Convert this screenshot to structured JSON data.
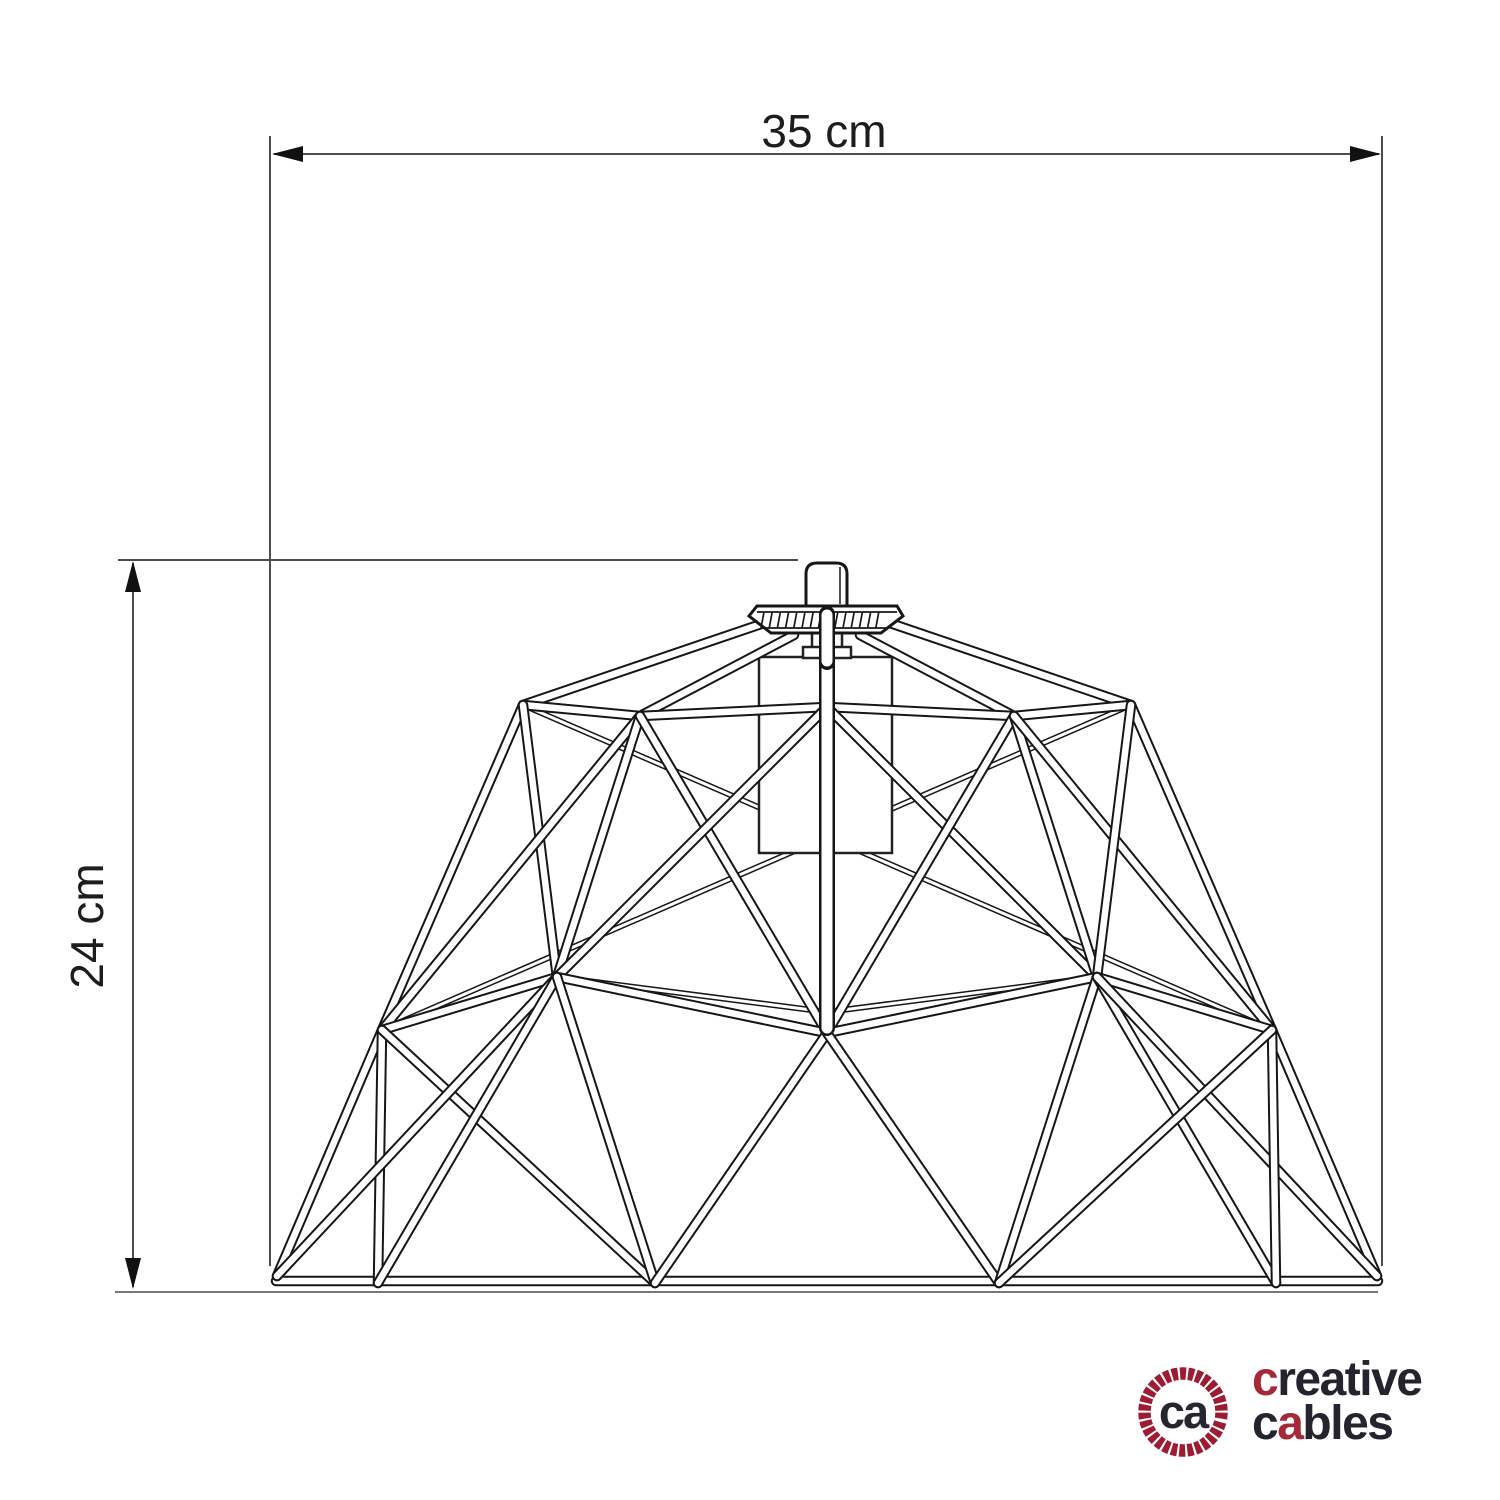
{
  "page": {
    "background": "#ffffff"
  },
  "dimensions": {
    "width_label": "35 cm",
    "height_label": "24 cm",
    "line_color": "#4d4d4d",
    "arrow_color": "#111111"
  },
  "logo": {
    "monogram": "ca",
    "word1": {
      "accent": "c",
      "rest": "reative"
    },
    "word2": {
      "pre": "c",
      "accent": "a",
      "rest": "bles"
    },
    "accent_color": "#a52a39",
    "text_color": "#24242e",
    "ring_color": "#9e1c33"
  },
  "drawing": {
    "stroke": "#161616",
    "fill": "#ffffff",
    "widths": {
      "m": [
        10.5,
        6.5
      ],
      "r": [
        16,
        11
      ],
      "t": [
        6,
        3
      ]
    },
    "back_struts": [
      [
        523,
        705,
        1272,
        1030,
        "t"
      ],
      [
        1131,
        705,
        382,
        1030,
        "t"
      ],
      [
        557,
        977,
        827,
        1012,
        "t"
      ],
      [
        827,
        1012,
        1097,
        977,
        "t"
      ]
    ],
    "struts": [
      [
        276,
        1281,
        1378,
        1281,
        "m"
      ],
      [
        277,
        1276,
        382,
        1030,
        "m"
      ],
      [
        382,
        1030,
        523,
        705,
        "m"
      ],
      [
        1377,
        1276,
        1272,
        1030,
        "m"
      ],
      [
        1272,
        1030,
        1131,
        705,
        "m"
      ],
      [
        523,
        705,
        770,
        621,
        "m"
      ],
      [
        1131,
        705,
        884,
        621,
        "m"
      ],
      [
        794,
        635,
        640,
        716,
        "m"
      ],
      [
        860,
        635,
        1014,
        716,
        "m"
      ],
      [
        523,
        705,
        640,
        716,
        "m"
      ],
      [
        640,
        716,
        827,
        707,
        "m"
      ],
      [
        827,
        707,
        1014,
        716,
        "m"
      ],
      [
        1014,
        716,
        1131,
        705,
        "m"
      ],
      [
        523,
        705,
        557,
        977,
        "m"
      ],
      [
        640,
        716,
        382,
        1030,
        "m"
      ],
      [
        640,
        716,
        557,
        977,
        "m"
      ],
      [
        640,
        716,
        827,
        1033,
        "m"
      ],
      [
        827,
        707,
        557,
        977,
        "m"
      ],
      [
        827,
        707,
        1097,
        977,
        "m"
      ],
      [
        1014,
        716,
        827,
        1033,
        "m"
      ],
      [
        1014,
        716,
        1097,
        977,
        "m"
      ],
      [
        1014,
        716,
        1272,
        1030,
        "m"
      ],
      [
        1131,
        705,
        1097,
        977,
        "m"
      ],
      [
        382,
        1030,
        557,
        977,
        "m"
      ],
      [
        557,
        977,
        827,
        1033,
        "m"
      ],
      [
        827,
        1033,
        1097,
        977,
        "m"
      ],
      [
        1097,
        977,
        1272,
        1030,
        "m"
      ],
      [
        382,
        1030,
        378,
        1283,
        "m"
      ],
      [
        382,
        1030,
        655,
        1283,
        "m"
      ],
      [
        277,
        1276,
        557,
        977,
        "m"
      ],
      [
        557,
        977,
        378,
        1283,
        "m"
      ],
      [
        557,
        977,
        655,
        1283,
        "m"
      ],
      [
        827,
        1033,
        655,
        1283,
        "m"
      ],
      [
        827,
        1033,
        999,
        1283,
        "m"
      ],
      [
        1097,
        977,
        999,
        1283,
        "m"
      ],
      [
        1097,
        977,
        1276,
        1283,
        "m"
      ],
      [
        1377,
        1276,
        1097,
        977,
        "m"
      ],
      [
        1272,
        1030,
        1276,
        1283,
        "m"
      ],
      [
        1272,
        1030,
        999,
        1283,
        "m"
      ],
      [
        827,
        616,
        827,
        1028,
        "r"
      ]
    ],
    "flange_hatch": {
      "x1": 764,
      "x2": 886,
      "step": 8.2,
      "y1": 612,
      "y2": 628
    }
  }
}
